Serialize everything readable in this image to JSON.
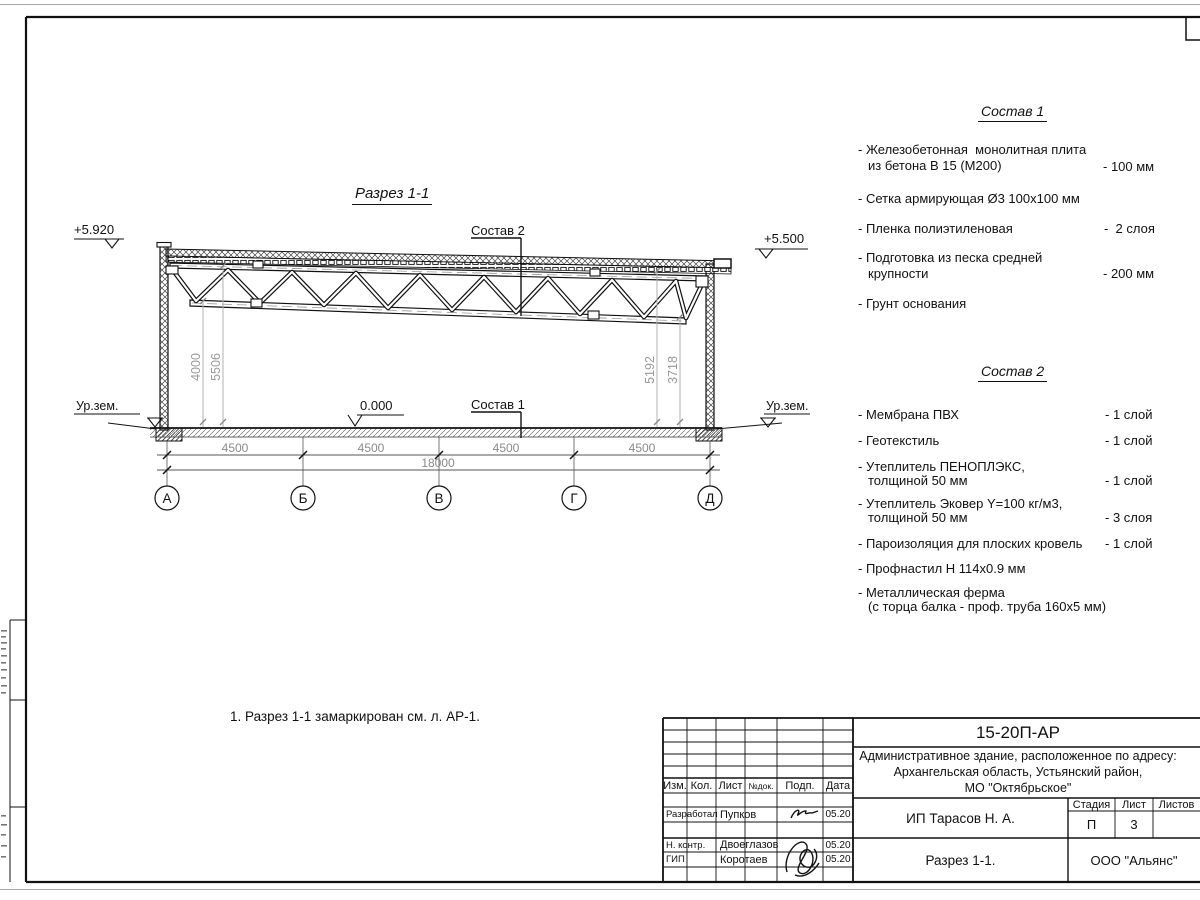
{
  "drawing": {
    "view_title": "Разрез 1-1",
    "note": "1. Разрез 1-1 замаркирован см. л. АР-1.",
    "elevation_top_left": "+5.920",
    "elevation_top_right": "+5.500",
    "elevation_zero": "0.000",
    "ground_label_left": "Ур.зем.",
    "ground_label_right": "Ур.зем.",
    "callout_roof": "Состав 2",
    "callout_floor": "Состав 1",
    "axes": [
      "А",
      "Б",
      "В",
      "Г",
      "Д"
    ],
    "span_dims": [
      "4500",
      "4500",
      "4500",
      "4500"
    ],
    "total_dim": "18000",
    "height_dims": [
      "4000",
      "5506",
      "5192",
      "3718"
    ]
  },
  "composition1": {
    "title": "Состав 1",
    "items": [
      {
        "line1": "- Железобетонная  монолитная плита",
        "line2": "из бетона В 15 (М200)",
        "value": "- 100 мм"
      },
      {
        "line1": "- Сетка армирующая Ø3 100х100 мм"
      },
      {
        "line1": "- Пленка полиэтиленовая",
        "value": "-  2 слоя"
      },
      {
        "line1": "- Подготовка из песка средней",
        "line2": "крупности",
        "value": "- 200 мм"
      },
      {
        "line1": "- Грунт основания"
      }
    ]
  },
  "composition2": {
    "title": "Состав 2",
    "items": [
      {
        "line1": "- Мембрана ПВХ",
        "value": "- 1 слой"
      },
      {
        "line1": "- Геотекстиль",
        "value": "- 1 слой"
      },
      {
        "line1": "- Утеплитель ПЕНОПЛЭКС,",
        "line2": "толщиной 50 мм",
        "value": "- 1 слой"
      },
      {
        "line1": "- Утеплитель Эковер Y=100 кг/м3,",
        "line2": "толщиной 50 мм",
        "value": "- 3 слоя"
      },
      {
        "line1": "- Пароизоляция для плоских кровель",
        "value": "- 1 слой"
      },
      {
        "line1": "- Профнастил Н 114х0.9 мм"
      },
      {
        "line1": "- Металлическая ферма",
        "line2": "(с торца балка - проф. труба 160х5 мм)"
      }
    ]
  },
  "title_block": {
    "code": "15-20П-АР",
    "project_address_line1": "Административное здание, расположенное по адресу:",
    "project_address_line2": "Архангельская область, Устьянский район,",
    "project_address_line3": "МО \"Октябрьское\"",
    "columns": {
      "izm": "Изм.",
      "kol": "Кол.",
      "list": "Лист",
      "ndok": "№док.",
      "podp": "Подп.",
      "data": "Дата"
    },
    "signature_rows": [
      {
        "role": "Разработал",
        "name": "Пупков",
        "date": "05.20"
      },
      {
        "role": "Н. контр.",
        "name": "Двоеглазов",
        "date": "05.20"
      },
      {
        "role": "ГИП",
        "name": "Коротаев",
        "date": "05.20"
      }
    ],
    "client": "ИП Тарасов Н. А.",
    "stage_label": "Стадия",
    "sheet_label": "Лист",
    "sheets_label": "Листов",
    "stage_value": "П",
    "sheet_value": "3",
    "doc_title": "Разрез 1-1.",
    "company": "ООО \"Альянс\""
  }
}
